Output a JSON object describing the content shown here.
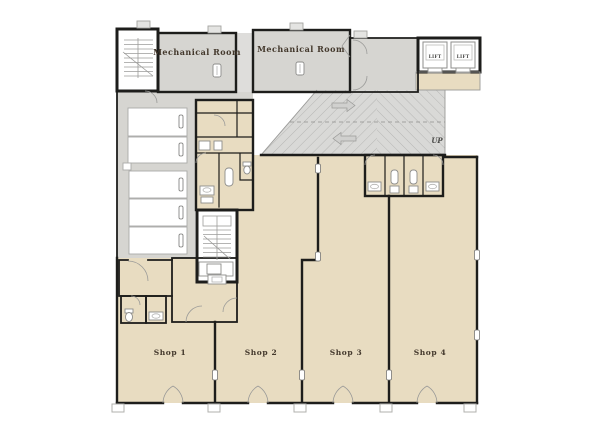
{
  "colors": {
    "wall": "#1d1d1b",
    "shop_floor": "#e8dcc1",
    "service_gray": "#d6d5d1",
    "between_strip": "#dedddb",
    "ramp_fill": "#d9d9d7",
    "hatch_line": "#b6b6b4",
    "label_ink": "#43382c",
    "thin_line": "#9a9a98",
    "white_room": "#ffffff"
  },
  "labels": {
    "mechanical_room_1": "Mechanical Room",
    "mechanical_room_2": "Mechanical Room",
    "lift_left": "LIFT",
    "lift_right": "LIFT",
    "ramp_up": "UP",
    "shop_1": "Shop 1",
    "shop_2": "Shop 2",
    "shop_3": "Shop 3",
    "shop_4": "Shop 4"
  },
  "floor_plan": {
    "labeled_rooms": [
      "Mechanical Room",
      "Mechanical Room",
      "LIFT",
      "LIFT",
      "Shop 1",
      "Shop 2",
      "Shop 3",
      "Shop 4"
    ],
    "annotations": [
      "UP"
    ],
    "icon_glyphs": [
      "stair-icon",
      "toilet-icon",
      "sink-icon",
      "urinal-icon",
      "door-arc-icon",
      "lift-car-icon",
      "ramp-hatch-pattern",
      "column-marker",
      "vent-tab"
    ]
  }
}
